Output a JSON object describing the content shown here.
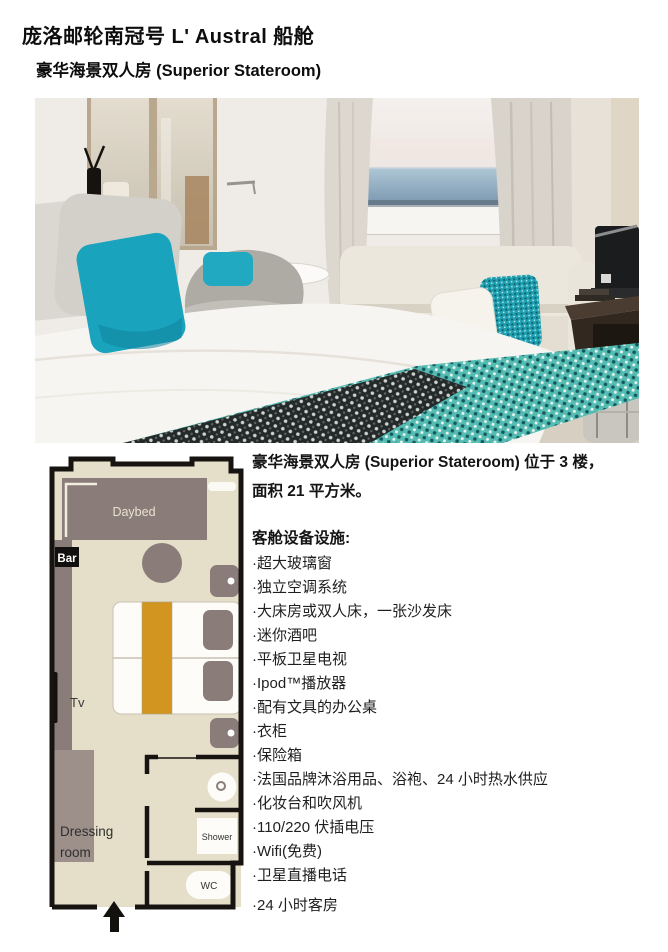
{
  "page": {
    "title": "庞洛邮轮南冠号 L' Austral 船舱",
    "subtitle": "豪华海景双人房 (Superior Stateroom)"
  },
  "details": {
    "intro_line1": "豪华海景双人房 (Superior Stateroom) 位于 3 楼，",
    "intro_line2": "面积 21 平方米。",
    "amenities_heading": "客舱设备设施:",
    "amenities": [
      "·超大玻璃窗",
      "·独立空调系统",
      "·大床房或双人床，一张沙发床",
      "·迷你酒吧",
      "·平板卫星电视",
      "·Ipod™播放器",
      "·配有文具的办公桌",
      "·衣柜",
      "·保险箱",
      "·法国品牌沐浴用品、浴袍、24 小时热水供应",
      "·化妆台和吹风机",
      "·110/220 伏插电压",
      "·Wifi(免费)",
      "·卫星直播电话",
      "·24 小时客房"
    ]
  },
  "floorplan": {
    "labels": {
      "daybed": "Daybed",
      "bar": "Bar",
      "tv": "Tv",
      "dressing_line1": "Dressing",
      "dressing_line2": "room",
      "shower": "Shower",
      "wc": "WC"
    }
  },
  "colors": {
    "accent_teal": "#1ba7bd",
    "runner_orange": "#d2951f",
    "plan_furniture": "#8a7c79",
    "plan_floor": "#e5dfca",
    "plan_wall": "#171310"
  }
}
